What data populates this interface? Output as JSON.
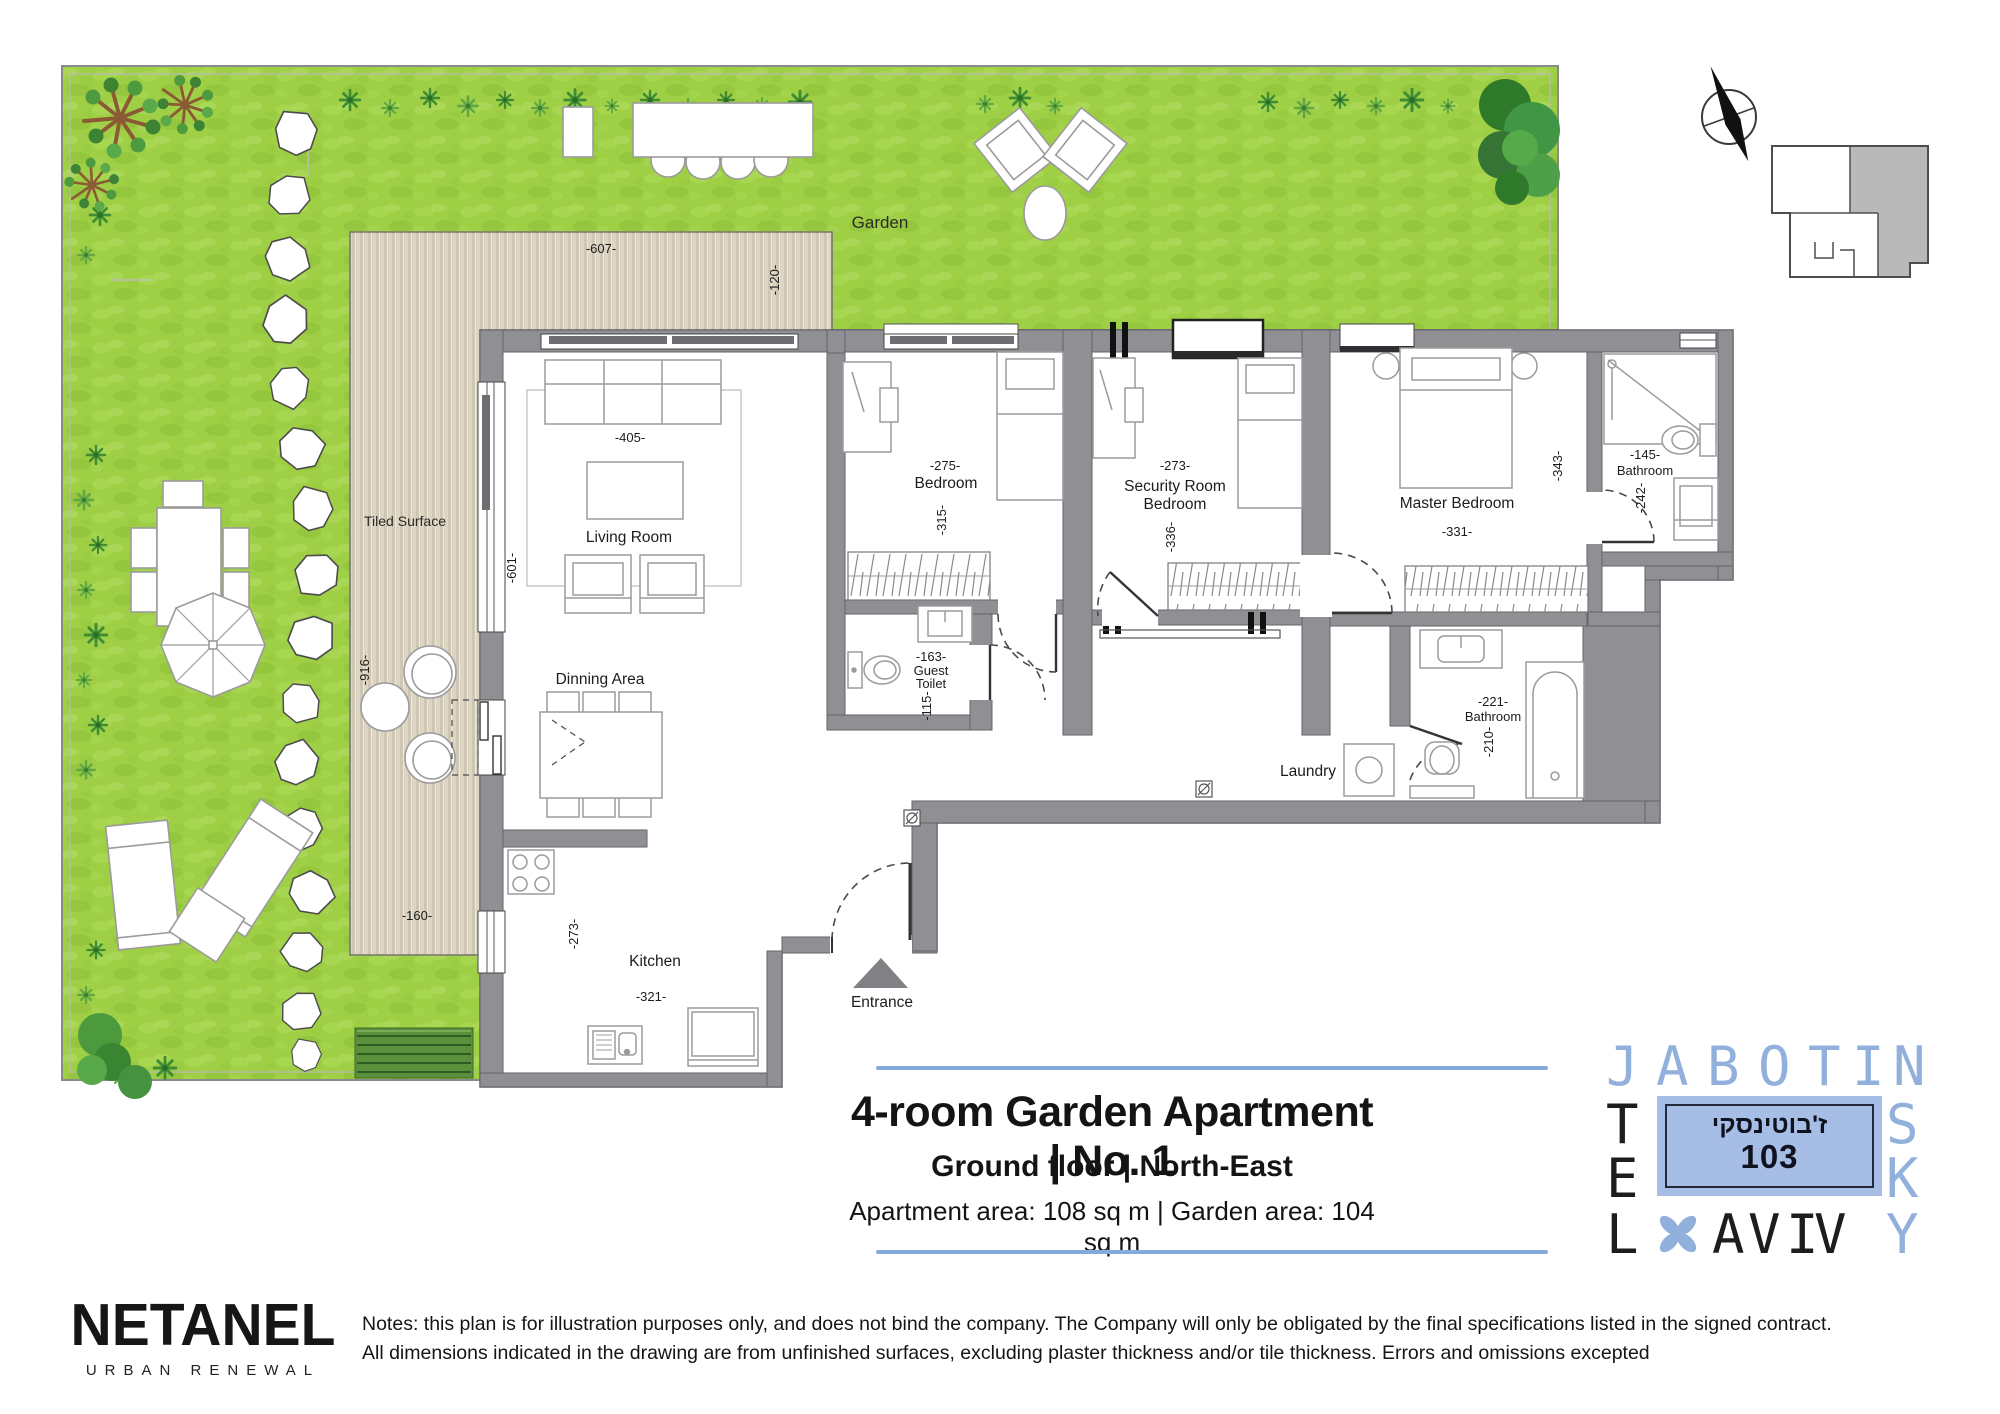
{
  "garden": {
    "label": "Garden",
    "tiled_label": "Tiled Surface",
    "deck_dim_w": "-607-",
    "deck_dim_d": "-120-",
    "deck_dim_h": "-916-",
    "deck_dim_bw": "-160-"
  },
  "rooms": {
    "living": {
      "name": "Living Room",
      "dim_w": "-405-",
      "dim_h": "-601-"
    },
    "dining": {
      "name": "Dinning Area"
    },
    "kitchen": {
      "name": "Kitchen",
      "dim_h": "-273-",
      "dim_w": "-321-"
    },
    "bedroom": {
      "name": "Bedroom",
      "dim_w": "-275-",
      "dim_h": "-315-"
    },
    "security": {
      "name_line1": "Security Room",
      "name_line2": "Bedroom",
      "dim_w": "-273-",
      "dim_h": "-336-"
    },
    "master": {
      "name": "Master Bedroom",
      "dim_w": "-331-",
      "dim_h": "-343-"
    },
    "bath1": {
      "name": "Bathroom",
      "dim_w": "-145-",
      "dim_h": "-242-"
    },
    "bath2": {
      "name": "Bathroom",
      "dim_w": "-221-",
      "dim_h": "-210-"
    },
    "guest_toilet": {
      "name_line1": "Guest",
      "name_line2": "Toilet",
      "dim_w": "-163-",
      "dim_h": "-115-"
    },
    "laundry": {
      "name": "Laundry"
    },
    "entrance": {
      "name": "Entrance"
    }
  },
  "title_block": {
    "title": "4-room Garden Apartment | No. 1",
    "subtitle": "Ground floor | North-East",
    "area_line": "Apartment area: 108 sq m | Garden area: 104 sq m"
  },
  "street_sign": {
    "hebrew": "ז'בוטינסקי",
    "number": "103"
  },
  "logo": {
    "row1": [
      "J",
      "A",
      "B",
      "O",
      "T",
      "I",
      "N"
    ],
    "row2_left": "T",
    "row2_right": "S",
    "row3_left": "E",
    "row3_right": "K",
    "row4": [
      "L",
      "A",
      "V",
      "I",
      "V",
      "Y"
    ]
  },
  "brand": {
    "name": "NETANEL",
    "tagline": "URBAN RENEWAL"
  },
  "notes": {
    "line1": "Notes: this plan is for illustration purposes only, and does not bind the company. The Company will only be obligated by the final specifications listed in the signed contract.",
    "line2": "All dimensions indicated in the drawing are from unfinished surfaces, excluding plaster thickness and/or tile thickness. Errors and omissions excepted"
  },
  "colors": {
    "accent_blue": "#85a9da",
    "logo_blue": "#92b0dc",
    "sign_fill": "#a6bee6",
    "grass": "#9ecf45",
    "wall_gray": "#8f8f94",
    "deck_beige": "#ddd5c3"
  }
}
